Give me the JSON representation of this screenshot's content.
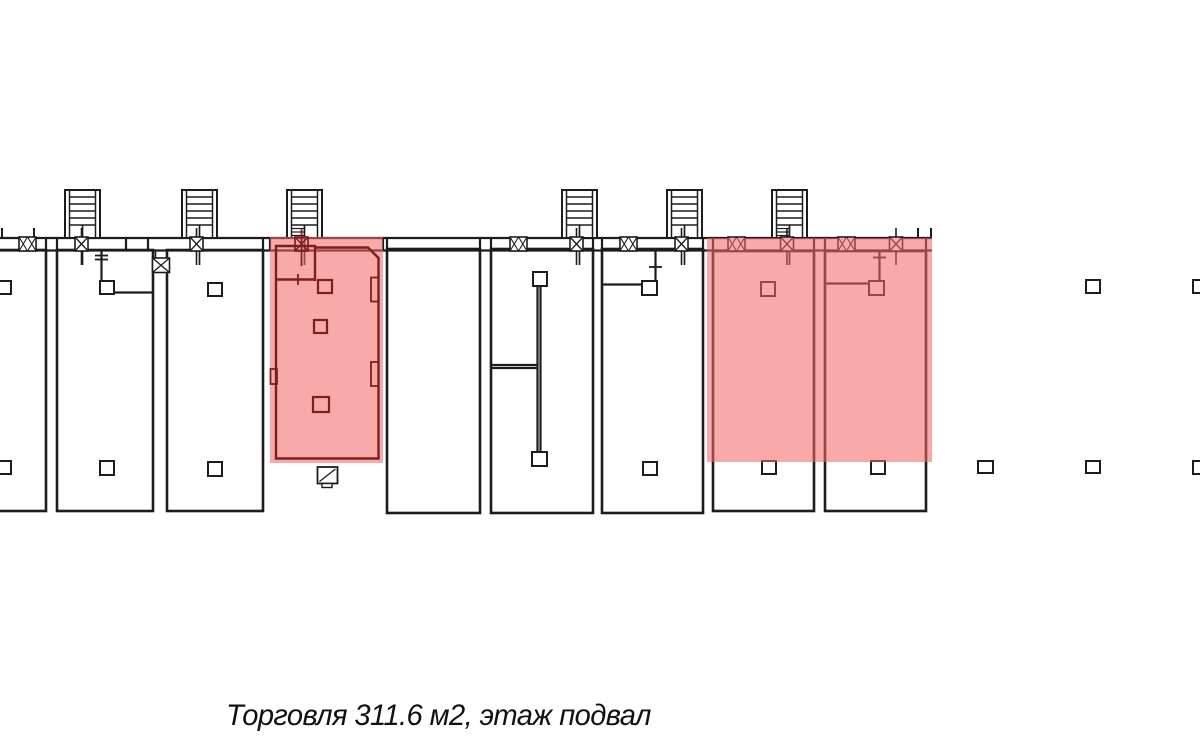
{
  "caption": "Торговля 311.6 м2, этаж подвал",
  "colors": {
    "wall": "#1c1c1c",
    "unit": "#7d1f1f",
    "highlight": "rgba(242,104,104,0.57)",
    "background": "#ffffff",
    "text": "#111111"
  },
  "plan": {
    "band": {
      "x1": -10,
      "x2": 932,
      "y_top": 238,
      "y_bottom": 250.5,
      "stubs_between": [
        46,
        57,
        126,
        148,
        263,
        270,
        383,
        387,
        480,
        491,
        593,
        602,
        703,
        713,
        814,
        825,
        926
      ],
      "stubs_above": [
        2,
        34,
        918,
        931
      ]
    },
    "stair_size": {
      "y": 190,
      "w": 35,
      "h": 48
    },
    "stairwells": [
      {
        "x": 65,
        "dense": false
      },
      {
        "x": 182,
        "dense": false
      },
      {
        "x": 287,
        "dense": true
      },
      {
        "x": 562,
        "dense": false
      },
      {
        "x": 667,
        "dense": false
      },
      {
        "x": 772,
        "dense": true
      }
    ],
    "rooms": [
      [
        -12,
        250,
        58,
        261
      ],
      [
        57,
        250,
        96,
        261
      ],
      [
        167,
        250,
        96,
        261
      ],
      [
        387,
        249,
        93,
        264
      ],
      [
        491,
        249,
        102,
        264
      ],
      [
        602,
        249,
        101,
        264
      ],
      [
        713,
        251,
        101,
        260
      ],
      [
        825,
        251,
        101,
        260
      ]
    ],
    "columns": [
      [
        -5,
        281,
        16,
        13
      ],
      [
        -5,
        461,
        16,
        13
      ],
      [
        100,
        281,
        14,
        13
      ],
      [
        100,
        461,
        14,
        14
      ],
      [
        208,
        283,
        14,
        13
      ],
      [
        208,
        462,
        14,
        14
      ],
      [
        533,
        272,
        14,
        14
      ],
      [
        532,
        452,
        15,
        14
      ],
      [
        642,
        281,
        15,
        14
      ],
      [
        643,
        462,
        14,
        13
      ],
      [
        761,
        282,
        14,
        14
      ],
      [
        762,
        461,
        14,
        13
      ],
      [
        869,
        281,
        15,
        14
      ],
      [
        871,
        461,
        14,
        13
      ],
      [
        978,
        461,
        15,
        12
      ],
      [
        1086,
        280,
        14,
        13
      ],
      [
        1086,
        461,
        14,
        12
      ],
      [
        1193,
        280,
        12,
        13
      ],
      [
        1193,
        461,
        12,
        13
      ]
    ],
    "window_size": {
      "y": 237,
      "w": 17,
      "h": 14
    },
    "windows": [
      27.5,
      518.5,
      628.5,
      736.5,
      846.5
    ],
    "door_size": {
      "y": 237,
      "w": 13,
      "h": 14,
      "line_y1": 228,
      "line_y2": 265
    },
    "doors": [
      81.5,
      196.5,
      576.5,
      681.5,
      787,
      896
    ],
    "low_window": {
      "x": 152.5,
      "y": 258,
      "w": 17,
      "h": 14.5,
      "stub_x1": 155.5,
      "stub_x2": 167
    },
    "partitions": [
      {
        "type": "v",
        "x": 101.5,
        "y1": 250,
        "y2": 281
      },
      {
        "type": "h",
        "y": 292.5,
        "x1": 114,
        "x2": 153
      },
      {
        "type": "tick-h",
        "x1": 95,
        "x2": 108,
        "y": 255.5
      },
      {
        "type": "tick-h",
        "x1": 95,
        "x2": 108,
        "y": 259.5
      },
      {
        "type": "v",
        "x": 537.5,
        "y1": 286,
        "y2": 452
      },
      {
        "type": "v",
        "x": 540.5,
        "y1": 286,
        "y2": 452
      },
      {
        "type": "h",
        "y": 365,
        "x1": 491,
        "x2": 537
      },
      {
        "type": "h",
        "y": 368,
        "x1": 491,
        "x2": 537
      },
      {
        "type": "h",
        "y": 284.5,
        "x1": 602,
        "x2": 642
      },
      {
        "type": "v",
        "x": 655.5,
        "y1": 250,
        "y2": 295
      },
      {
        "type": "tick-h",
        "x1": 649,
        "x2": 662,
        "y": 267
      },
      {
        "type": "h",
        "y": 283.5,
        "x1": 826,
        "x2": 869
      },
      {
        "type": "v",
        "x": 879.5,
        "y1": 251,
        "y2": 281
      },
      {
        "type": "tick-h",
        "x1": 873,
        "x2": 886,
        "y": 257.5
      }
    ],
    "hatch_box": {
      "x": 317.5,
      "y": 467,
      "w": 20,
      "h": 16.5,
      "tab": [
        322,
        483.5,
        10,
        4
      ]
    },
    "overlays": [
      [
        270,
        237,
        113,
        226
      ],
      [
        707,
        238,
        225,
        224
      ]
    ],
    "unit": {
      "outline": "M 315,247.5 L 368,247.5 L 378.5,258 L 378.5,458.5 L 276,458.5 L 276,246 L 315,246 L 315,281",
      "subroom_wall": {
        "x1": 276,
        "x2": 315,
        "y": 279.5
      },
      "subroom_tick": {
        "x": 298,
        "y1": 274,
        "y2": 285
      },
      "notches": [
        [
          270.5,
          369,
          6.5,
          15
        ],
        [
          371,
          277.5,
          7.5,
          24
        ],
        [
          371,
          362,
          7.5,
          24
        ]
      ],
      "columns": [
        [
          318,
          280,
          14,
          13
        ],
        [
          314,
          320,
          13,
          13
        ],
        [
          313,
          397,
          16,
          15
        ]
      ],
      "door": {
        "cx": 301.5,
        "y": 237,
        "w": 13,
        "h": 14,
        "line_y1": 228,
        "line_y2": 266
      }
    }
  }
}
